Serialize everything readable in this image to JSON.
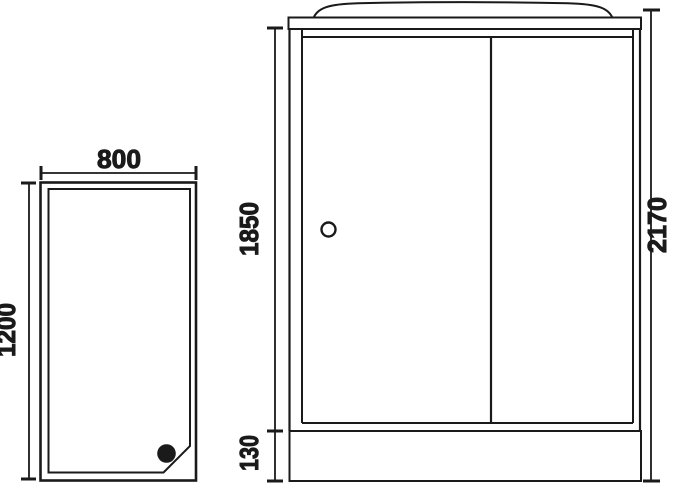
{
  "page": {
    "background": "#ffffff",
    "line_color": "#1a1a1a"
  },
  "tray_top_view": {
    "description": "shower tray plan view with drain",
    "width_mm": "800",
    "depth_mm": "1200"
  },
  "cabin_front_view": {
    "description": "shower cabin front elevation with two sliding doors",
    "door_height_mm": "1850",
    "base_height_mm": "130",
    "total_height_mm": "2170"
  }
}
